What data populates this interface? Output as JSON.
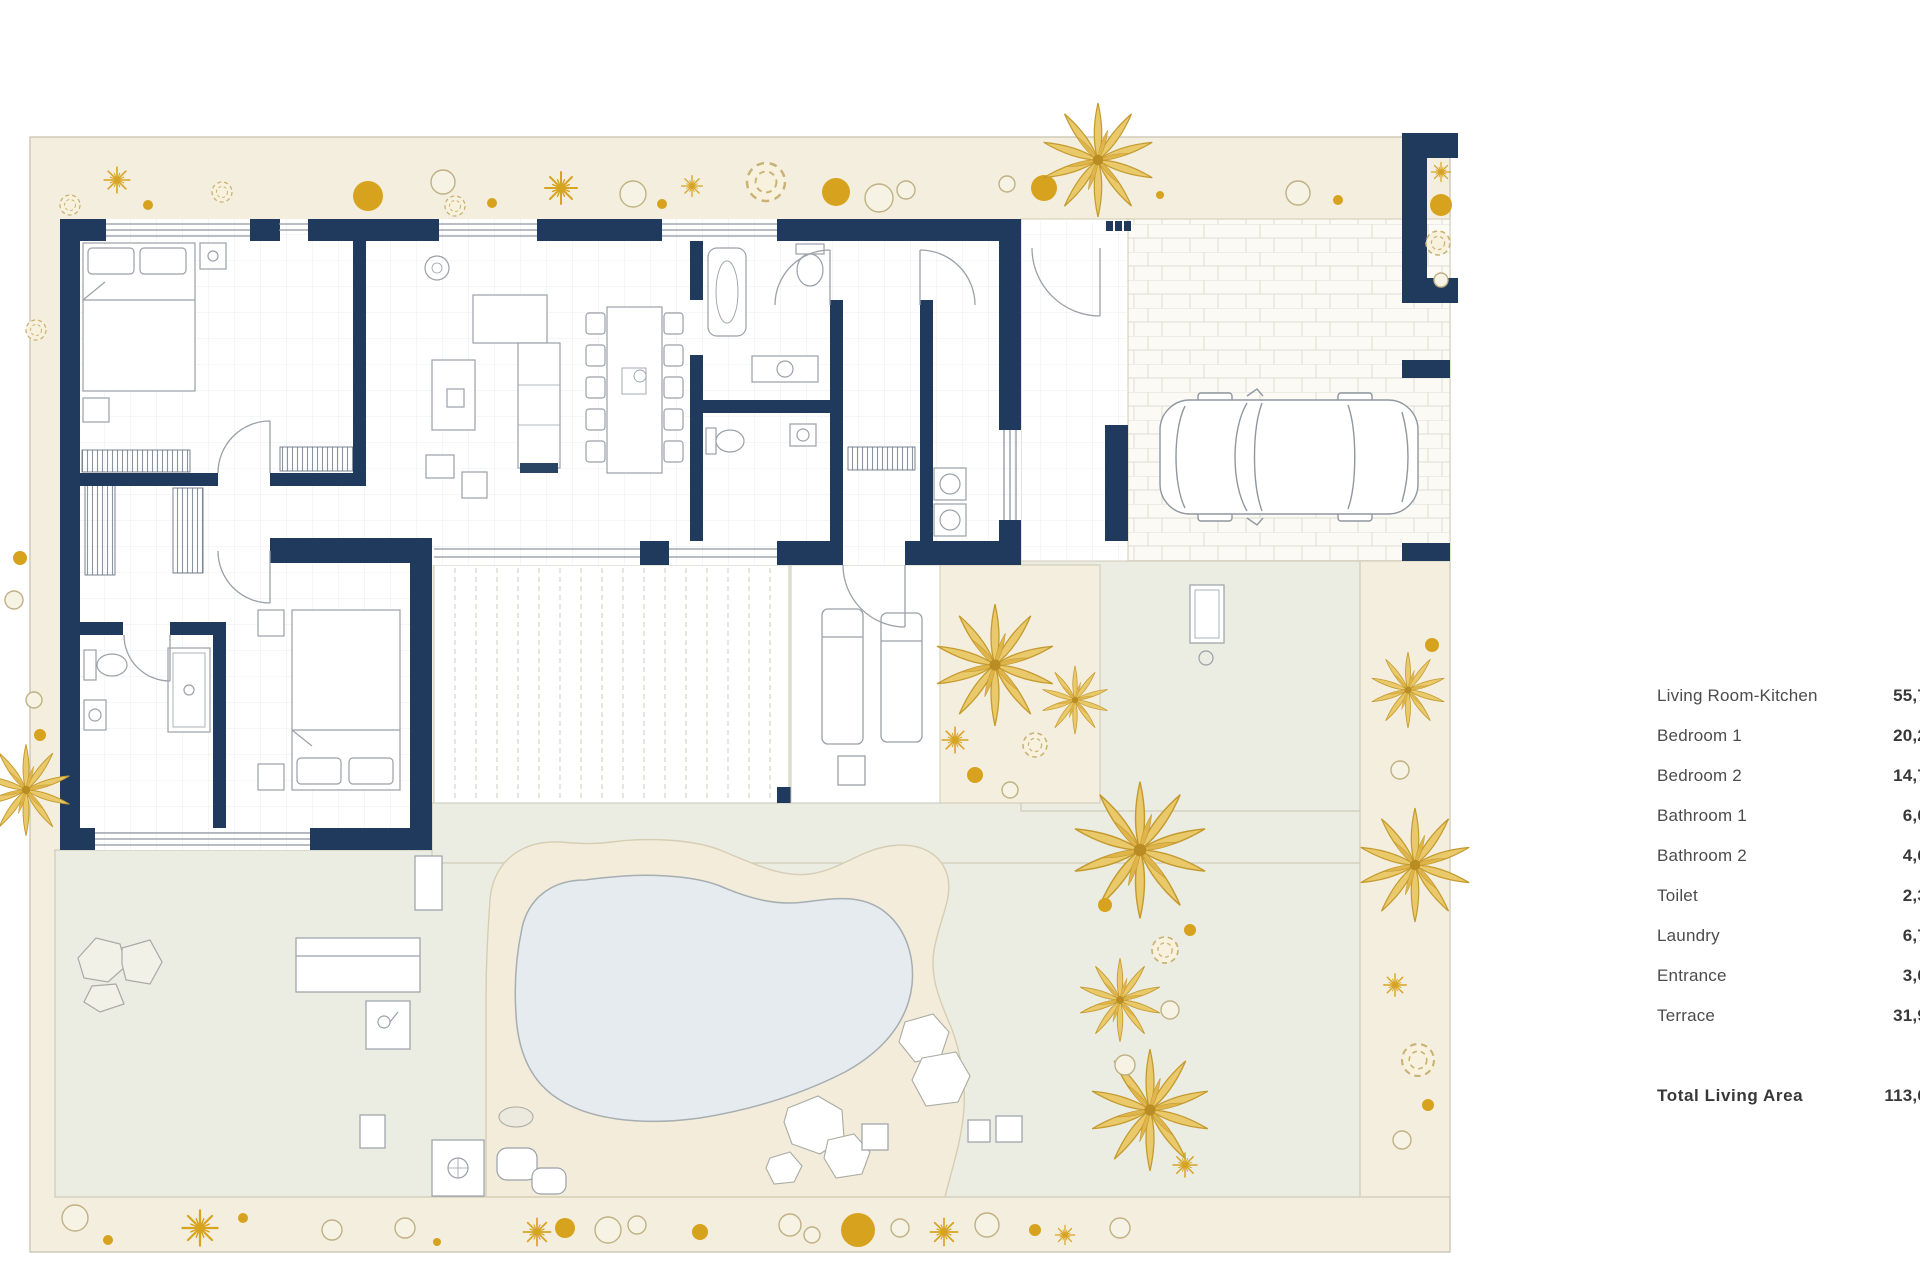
{
  "document": {
    "type": "architectural-floor-plan",
    "description": "Single-storey villa plan with garden, pool, deck terrace and carport"
  },
  "legend": {
    "rows": [
      {
        "label": "Living Room-Kitchen",
        "value": "55,7"
      },
      {
        "label": "Bedroom 1",
        "value": "20,2"
      },
      {
        "label": "Bedroom 2",
        "value": "14,7"
      },
      {
        "label": "Bathroom 1",
        "value": "6,0"
      },
      {
        "label": "Bathroom 2",
        "value": "4,6"
      },
      {
        "label": "Toilet",
        "value": "2,3"
      },
      {
        "label": "Laundry",
        "value": "6,7"
      },
      {
        "label": "Entrance",
        "value": "3,0"
      },
      {
        "label": "Terrace",
        "value": "31,9"
      }
    ],
    "total": {
      "label": "Total Living Area",
      "value": "113,6"
    }
  },
  "colors": {
    "wall_navy": "#1f3a5c",
    "plot_beige": "#f4eede",
    "terrace_gray": "#ebece2",
    "pool_water": "#e5ebee",
    "pool_sand": "#f3ecda",
    "vegetation_gold": "#d7a21d",
    "furniture_line": "#9aa1a8"
  }
}
